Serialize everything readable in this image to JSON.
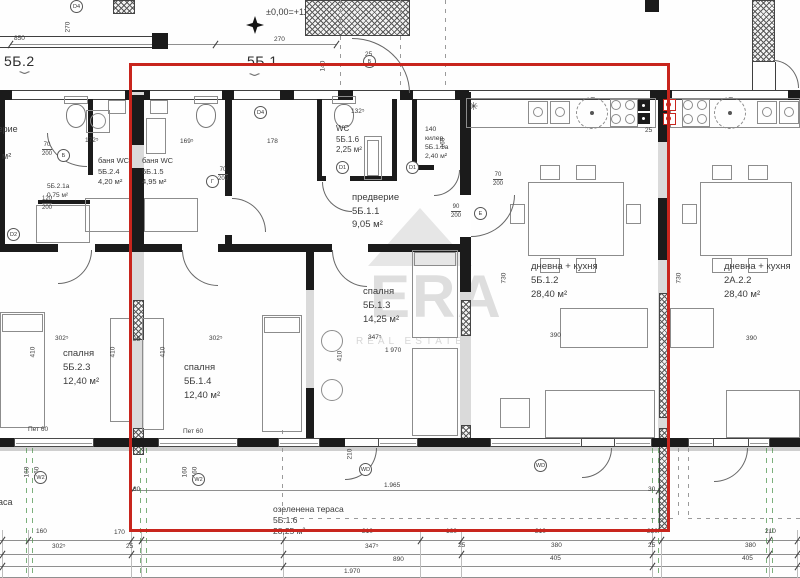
{
  "drawing": {
    "level_mark": "±0,00=+110,50",
    "watermark": {
      "brand": "ERA",
      "tagline": "REAL ESTATE"
    },
    "highlight_color": "#c8251d"
  },
  "headers": [
    {
      "text": "5Б.2",
      "x": 4,
      "y": 54
    },
    {
      "text": "5Б.1",
      "x": 247,
      "y": 54
    }
  ],
  "room_labels": [
    {
      "lines": [
        "баня WC",
        "5Б.2.4",
        "4,20 м²"
      ],
      "x": 98,
      "y": 156,
      "fs": 7.5,
      "lh": 10.5
    },
    {
      "lines": [
        "баня WC",
        "5Б.1.5",
        "4,95 м²"
      ],
      "x": 142,
      "y": 156,
      "fs": 7.5,
      "lh": 10.5
    },
    {
      "lines": [
        "WC",
        "5Б.1.6",
        "2,25 м²"
      ],
      "x": 336,
      "y": 124,
      "fs": 8,
      "lh": 10.5
    },
    {
      "lines": [
        "140",
        "килер",
        "5Б.1.1а",
        "2,40 м²"
      ],
      "x": 425,
      "y": 125,
      "fs": 6.8,
      "lh": 9
    },
    {
      "lines": [
        "предверие",
        "5Б.1.1",
        "9,05 м²"
      ],
      "x": 352,
      "y": 191,
      "fs": 9.5,
      "lh": 13.5
    },
    {
      "lines": [
        "спалня",
        "5Б.2.3",
        "12,40 м²"
      ],
      "x": 63,
      "y": 347,
      "fs": 9.5,
      "lh": 14
    },
    {
      "lines": [
        "спалня",
        "5Б.1.4",
        "12,40 м²"
      ],
      "x": 184,
      "y": 361,
      "fs": 9.5,
      "lh": 14
    },
    {
      "lines": [
        "спалня",
        "5Б.1.3",
        "14,25 м²"
      ],
      "x": 363,
      "y": 285,
      "fs": 9.5,
      "lh": 14
    },
    {
      "lines": [
        "дневна + кухня",
        "5Б.1.2",
        "28,40 м²"
      ],
      "x": 531,
      "y": 260,
      "fs": 9.5,
      "lh": 14
    },
    {
      "lines": [
        "дневна + кухня",
        "2А.2.2",
        "28,40 м²"
      ],
      "x": 724,
      "y": 260,
      "fs": 9.5,
      "lh": 14
    },
    {
      "lines": [
        "озеленена тераса",
        "5Б.1.6",
        "28,25 м²"
      ],
      "x": 273,
      "y": 504,
      "fs": 8.5,
      "lh": 11
    },
    {
      "lines": [
        "предверие"
      ],
      "x": -27,
      "y": 124,
      "fs": 9,
      "lh": 11
    },
    {
      "lines": [
        "м²"
      ],
      "x": 2,
      "y": 151,
      "fs": 9,
      "lh": 11
    },
    {
      "lines": [
        "5Б.2.1а",
        "0,75 м²"
      ],
      "x": 47,
      "y": 182,
      "fs": 6.5,
      "lh": 9
    },
    {
      "lines": [
        "тераса"
      ],
      "x": -16,
      "y": 497,
      "fs": 9,
      "lh": 11
    }
  ],
  "dim_labels": [
    {
      "t": "850",
      "x": 14,
      "y": 36
    },
    {
      "t": "270",
      "x": 274,
      "y": 37
    },
    {
      "t": "140",
      "x": 327,
      "y": 47,
      "rot": true
    },
    {
      "t": "25",
      "x": 365,
      "y": 52
    },
    {
      "t": "270",
      "x": 72,
      "y": 8,
      "rot": true
    },
    {
      "t": "160",
      "x": 447,
      "y": 124,
      "rot": true
    },
    {
      "t": "25",
      "x": 645,
      "y": 128
    },
    {
      "t": "172⁵",
      "x": 85,
      "y": 138
    },
    {
      "t": "169⁵",
      "x": 180,
      "y": 139
    },
    {
      "t": "178",
      "x": 267,
      "y": 139
    },
    {
      "t": "132⁵",
      "x": 351,
      "y": 109
    },
    {
      "t": "302⁵",
      "x": 55,
      "y": 336
    },
    {
      "t": "410",
      "x": 37,
      "y": 333,
      "rot": true
    },
    {
      "t": "410",
      "x": 117,
      "y": 333,
      "rot": true
    },
    {
      "t": "302⁵",
      "x": 209,
      "y": 336
    },
    {
      "t": "410",
      "x": 167,
      "y": 333,
      "rot": true
    },
    {
      "t": "25",
      "x": 133,
      "y": 337
    },
    {
      "t": "347⁵",
      "x": 368,
      "y": 335
    },
    {
      "t": "410",
      "x": 344,
      "y": 337,
      "rot": true
    },
    {
      "t": "1 970",
      "x": 385,
      "y": 348
    },
    {
      "t": "730",
      "x": 508,
      "y": 259,
      "rot": true
    },
    {
      "t": "730",
      "x": 683,
      "y": 259,
      "rot": true
    },
    {
      "t": "390",
      "x": 550,
      "y": 333
    },
    {
      "t": "390",
      "x": 746,
      "y": 336
    },
    {
      "t": "Пет 60",
      "x": 28,
      "y": 427
    },
    {
      "t": "Пет 60",
      "x": 183,
      "y": 429
    },
    {
      "t": "160",
      "x": 31,
      "y": 453,
      "rot": true
    },
    {
      "t": "160",
      "x": 41,
      "y": 453,
      "rot": true
    },
    {
      "t": "160",
      "x": 189,
      "y": 453,
      "rot": true
    },
    {
      "t": "160",
      "x": 199,
      "y": 453,
      "rot": true
    },
    {
      "t": "210",
      "x": 354,
      "y": 435,
      "rot": true
    },
    {
      "t": "1.965",
      "x": 384,
      "y": 483
    },
    {
      "t": "30",
      "x": 133,
      "y": 487
    },
    {
      "t": "30",
      "x": 648,
      "y": 487
    },
    {
      "t": "160",
      "x": 36,
      "y": 529
    },
    {
      "t": "170",
      "x": 114,
      "y": 530
    },
    {
      "t": "210",
      "x": 362,
      "y": 529
    },
    {
      "t": "160",
      "x": 446,
      "y": 529
    },
    {
      "t": "210",
      "x": 535,
      "y": 529
    },
    {
      "t": "280",
      "x": 647,
      "y": 529
    },
    {
      "t": "210",
      "x": 765,
      "y": 529
    },
    {
      "t": "302⁵",
      "x": 52,
      "y": 544
    },
    {
      "t": "25",
      "x": 126,
      "y": 544
    },
    {
      "t": "347⁵",
      "x": 365,
      "y": 544
    },
    {
      "t": "25",
      "x": 458,
      "y": 543
    },
    {
      "t": "380",
      "x": 551,
      "y": 543
    },
    {
      "t": "25",
      "x": 648,
      "y": 543
    },
    {
      "t": "380",
      "x": 745,
      "y": 543
    },
    {
      "t": "890",
      "x": 393,
      "y": 557
    },
    {
      "t": "405",
      "x": 550,
      "y": 556
    },
    {
      "t": "405",
      "x": 742,
      "y": 556
    },
    {
      "t": "1.970",
      "x": 344,
      "y": 569
    }
  ],
  "door_fractions": [
    {
      "top": "70",
      "bottom": "200",
      "x": 42,
      "y": 142
    },
    {
      "top": "120",
      "bottom": "200",
      "x": 42,
      "y": 196
    },
    {
      "top": "70",
      "bottom": "200",
      "x": 218,
      "y": 167
    },
    {
      "top": "70",
      "bottom": "200",
      "x": 493,
      "y": 172
    },
    {
      "top": "90",
      "bottom": "200",
      "x": 451,
      "y": 204
    }
  ],
  "circle_markers": [
    {
      "t": "D4",
      "x": 70,
      "y": 0
    },
    {
      "t": "D4",
      "x": 254,
      "y": 106
    },
    {
      "t": "D2",
      "x": 7,
      "y": 228
    },
    {
      "t": "D1",
      "x": 336,
      "y": 161
    },
    {
      "t": "D1",
      "x": 406,
      "y": 161
    },
    {
      "t": "Б",
      "x": 57,
      "y": 149
    },
    {
      "t": "Г",
      "x": 206,
      "y": 175
    },
    {
      "t": "Е",
      "x": 474,
      "y": 207
    },
    {
      "t": "Б",
      "x": 363,
      "y": 55
    },
    {
      "t": "W2",
      "x": 34,
      "y": 471
    },
    {
      "t": "W2",
      "x": 192,
      "y": 473
    },
    {
      "t": "WD",
      "x": 359,
      "y": 463
    },
    {
      "t": "WD",
      "x": 534,
      "y": 459
    }
  ],
  "misc_symbols": [
    {
      "t": "✳",
      "x": 469,
      "y": 102,
      "fs": 11
    },
    {
      "t": "⌄",
      "x": 20,
      "y": 66,
      "chev": true
    },
    {
      "t": "⌄",
      "x": 250,
      "y": 68,
      "chev": true
    }
  ]
}
